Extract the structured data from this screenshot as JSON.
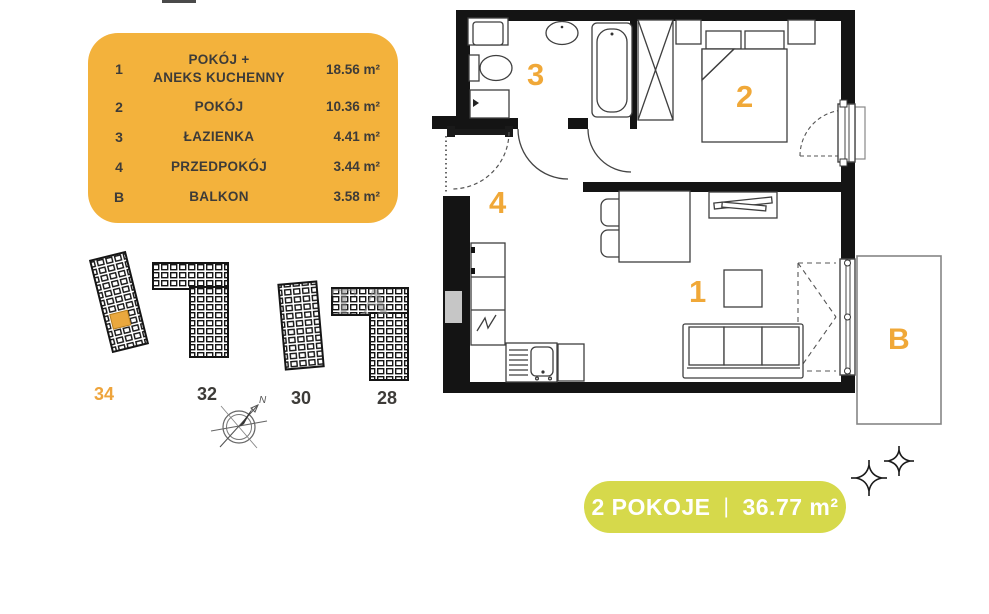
{
  "legend": {
    "bg_color": "#f3b23c",
    "text_color": "#3d3b38",
    "rows": [
      {
        "number": "1",
        "name": "POKÓJ +\nANEKS KUCHENNY",
        "area": "18.56 m²"
      },
      {
        "number": "2",
        "name": "POKÓJ",
        "area": "10.36 m²"
      },
      {
        "number": "3",
        "name": "ŁAZIENKA",
        "area": "4.41 m²"
      },
      {
        "number": "4",
        "name": "PRZEDPOKÓJ",
        "area": "3.44 m²"
      },
      {
        "number": "B",
        "name": "BALKON",
        "area": "3.58 m²"
      }
    ]
  },
  "floorplan": {
    "label_color": "#f0a838",
    "room_labels": {
      "living": "1",
      "bedroom": "2",
      "bathroom": "3",
      "hall": "4",
      "balcony": "B"
    }
  },
  "siteplan": {
    "active_color": "#eea43b",
    "buildings": [
      {
        "label": "34",
        "active": true
      },
      {
        "label": "32",
        "active": false
      },
      {
        "label": "30",
        "active": false
      },
      {
        "label": "28",
        "active": false
      }
    ],
    "watermark": "TA"
  },
  "compass": {
    "north_label": "N"
  },
  "summary_pill": {
    "bg_color": "#d6d94b",
    "rooms_label": "2 POKOJE",
    "separator": "|",
    "area": "36.77 m²"
  }
}
